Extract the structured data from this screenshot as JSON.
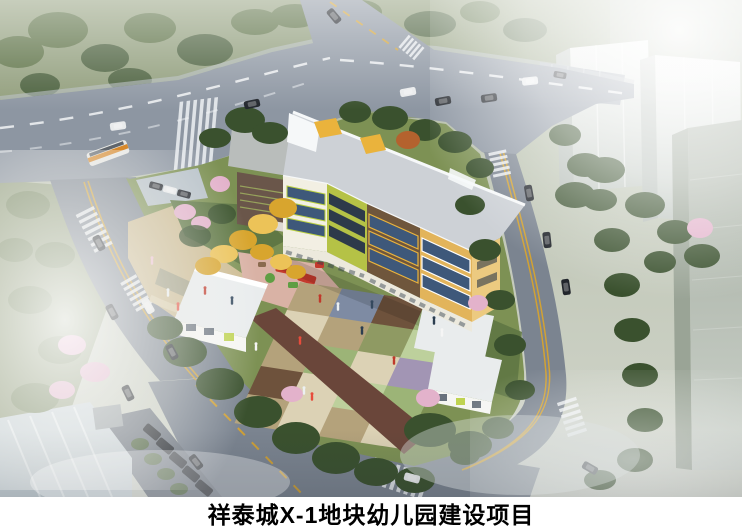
{
  "caption": {
    "title": "祥泰城X-1地块幼儿园建设项目"
  },
  "scene": {
    "palette": {
      "bgTop": "#aeb8a1",
      "bgBottom": "#cfd3c9",
      "parkGreen": "#8d9a77",
      "parkDark": "#6d7c58",
      "road": "#8d96a2",
      "roadSide": "#7b8490",
      "roadShade": "#3a424d",
      "laneWhite": "#f2f4f6",
      "laneYellow": "#d7a32e",
      "sidewalk": "#b8bec3",
      "lawn": "#7d9154",
      "lawnDark": "#5f7744",
      "plazaTan": "#ccba90",
      "plazaLight": "#ddd0ab",
      "paverDark": "#8a8f77",
      "treeDark": "#3a512e",
      "treeMid": "#5c7145",
      "treeHaze": "#7a8a64",
      "treeYellow": "#d8a52e",
      "treeYellowLight": "#ecc358",
      "treePink": "#e3b2cb",
      "roofGray": "#cdd1d6",
      "roofWing": "#b9bdbb",
      "parapetWhite": "#f6f8f9",
      "accentYellow": "#eab33c",
      "facadeWhite": "#f2efe3",
      "facadeLime": "#b5c246",
      "facadeBrown": "#6f563c",
      "facadeYellow": "#e2b45b",
      "facadeYellowEnd": "#ecca80",
      "wingBrown": "#6a564a",
      "louverGreen": "#9cab5e",
      "windowGlass": "#3e587a",
      "windowDark": "#2d3a4a",
      "groundFloor": "#ece9dd",
      "annexRoof": "#e9eced",
      "annexWall": "#f6f6f3",
      "accentLime": "#b9cf3f",
      "playPink": "#d9b2a5",
      "playRed": "#c43a2d",
      "playGreen": "#5f9e43",
      "towerFace": "#cbd2cc",
      "towerSide": "#b4bcb6",
      "towerFar": "#a8b1a3",
      "towerFront": "#9aa496",
      "carDark": "#22262c",
      "carWhite": "#e9ebec",
      "busOrange": "#d8892b",
      "canopyGlass": "#cdd7dc",
      "hedge": "#49603a",
      "captionBg": "#ffffff",
      "captionText": "#000000",
      "tileStrip": "#6a463a"
    },
    "courtyard": {
      "colors": {
        "tan": "#b4a27b",
        "slate": "#7e8ba3",
        "brown": "#6e523c",
        "cream": "#dcd2b5",
        "green": "#9cb477",
        "lime": "#bdd09c",
        "purple": "#a295b4",
        "olive": "#8f9a63"
      },
      "rows": [
        [
          "tan",
          "slate",
          "brown",
          "green"
        ],
        [
          "cream",
          "tan",
          "olive",
          "lime"
        ],
        [
          "tan",
          "green",
          "cream",
          "purple"
        ],
        [
          "brown",
          "cream",
          "lime",
          "green"
        ],
        [
          "tan",
          "cream",
          "tan",
          "cream"
        ]
      ]
    }
  }
}
